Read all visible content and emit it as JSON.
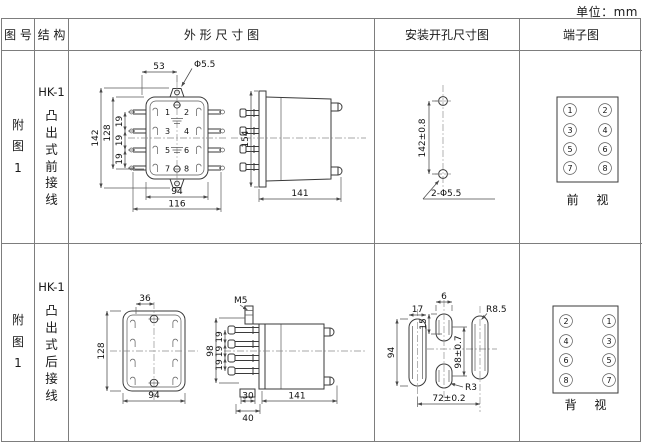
{
  "unit_label": "单位：mm",
  "header": {
    "figure_no": "图 号",
    "structure": "结 构",
    "outline": "外 形 尺 寸 图",
    "mounting": "安装开孔尺寸图",
    "terminal": "端子图"
  },
  "rows": [
    {
      "figure": "附图1",
      "model": "HK-1",
      "structure": "凸出式前接线",
      "outline": {
        "dim_top": "53",
        "hole_label": "Φ5.5",
        "dim_height_outer": "142",
        "dim_height_inner": "128",
        "dim_pitch": "19",
        "dim_width": "94",
        "dim_width_outer": "116",
        "terminals": [
          "1",
          "2",
          "3",
          "4",
          "5",
          "6",
          "7",
          "8"
        ],
        "side_height": "154",
        "side_depth": "141"
      },
      "mounting": {
        "dim_vertical": "142±0.8",
        "hole_label": "2-Φ5.5"
      },
      "terminal": {
        "left": [
          "1",
          "3",
          "5",
          "7"
        ],
        "right": [
          "2",
          "4",
          "6",
          "8"
        ],
        "view": "前 视"
      }
    },
    {
      "figure": "附图1",
      "model": "HK-1",
      "structure": "凸出式后接线",
      "outline": {
        "dim_top": "36",
        "dim_height": "128",
        "dim_width": "94",
        "screw_label": "M5",
        "side_height": "98",
        "dim_pitch": "19",
        "dim_foot": "30",
        "dim_base": "40",
        "side_depth": "141"
      },
      "mounting": {
        "dim_slot_width": "17",
        "dim_mid_width": "6",
        "dim_mid_offset": "15",
        "radius_large": "R8.5",
        "dim_left_height": "94",
        "dim_center_height": "98±0.7",
        "radius_small": "R3",
        "dim_span": "72±0.2"
      },
      "terminal": {
        "left": [
          "2",
          "4",
          "6",
          "8"
        ],
        "right": [
          "1",
          "3",
          "5",
          "7"
        ],
        "view": "背 视"
      }
    }
  ]
}
